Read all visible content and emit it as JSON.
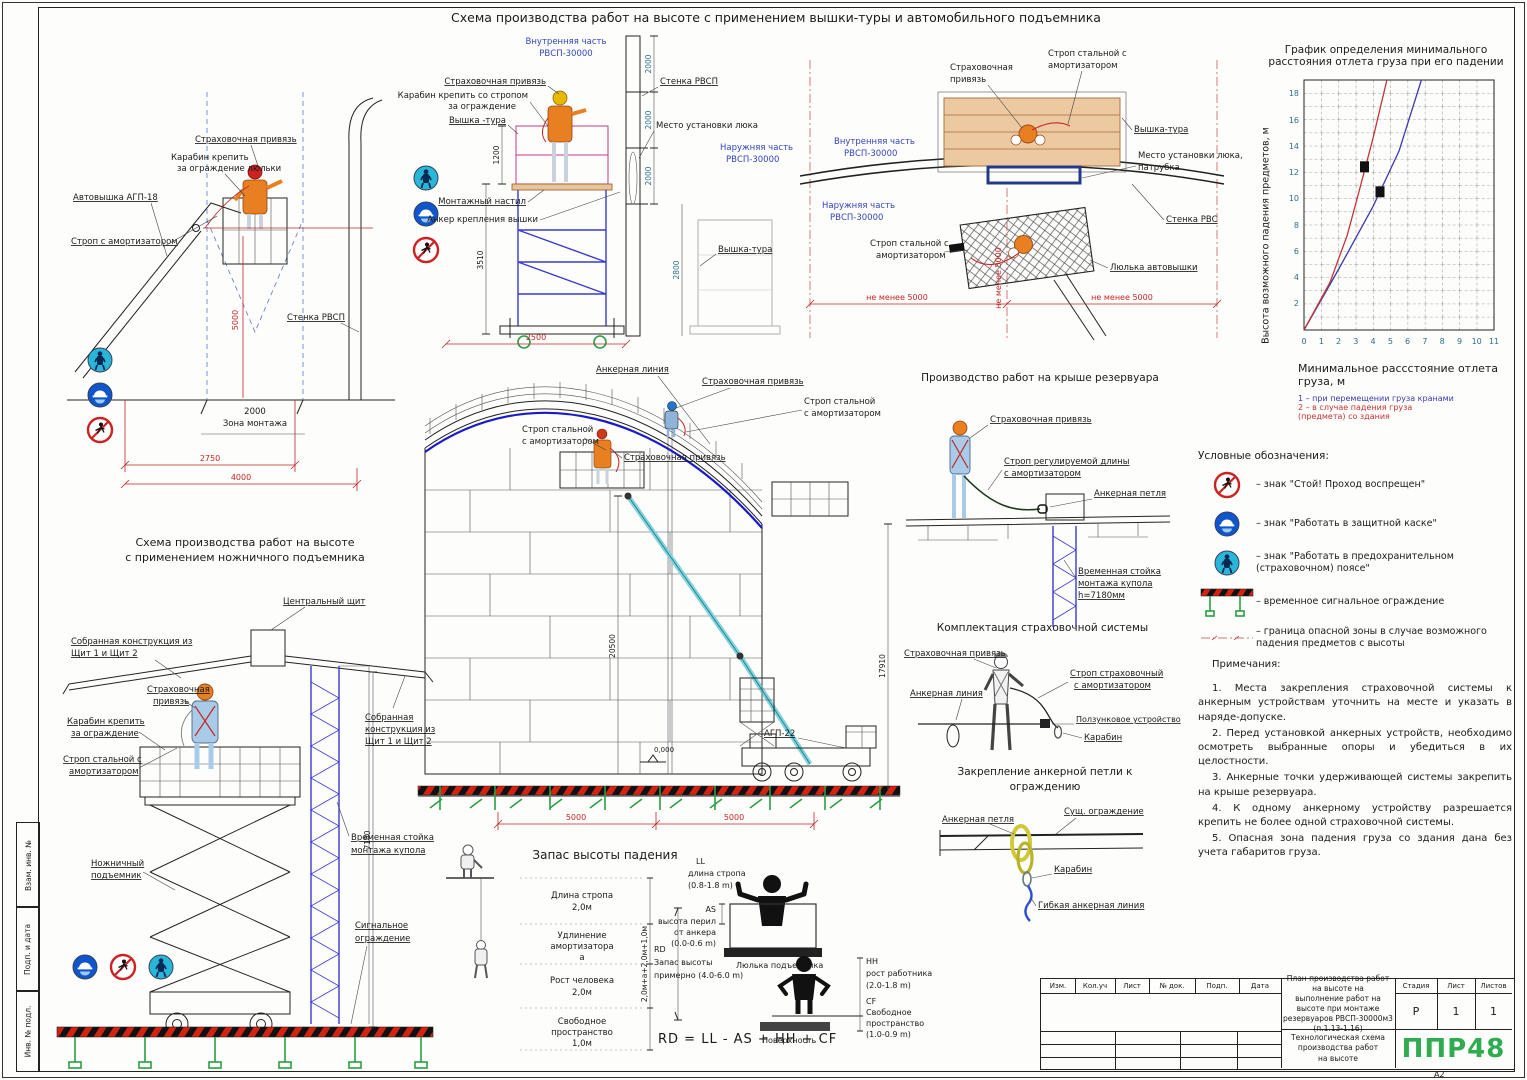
{
  "sheet": {
    "title": "Схема производства работ на высоте с применением вышки-туры и автомобильного подъемника",
    "format_label": "А2"
  },
  "margin_stamps": {
    "vzam": "Взам. инв. №",
    "podp": "Подп. и дата",
    "inv": "Инв. № подл."
  },
  "d_avto": {
    "privyaz": "Страховочная привязь",
    "karabin1": "Карабин крепить",
    "karabin2": "за ограждение люльки",
    "avtovyshka": "Автовышка АГП-18",
    "strop": "Строп с амортизатором",
    "stenka": "Стенка РВСП",
    "dim_5000": "5000",
    "dim_2000": "2000",
    "zona": "Зона монтажа",
    "dim_2750": "2750",
    "dim_4000": "4000"
  },
  "d_tura": {
    "inner1": "Внутренняя часть",
    "inner2": "РВСП-30000",
    "outer1": "Наружняя часть",
    "outer2": "РВСП-30000",
    "stenka": "Стенка РВСП",
    "privyaz": "Страховочная привязь",
    "karabin1": "Карабин крепить со стропом",
    "karabin2": "за ограждение",
    "tura_left": "Вышка -тура",
    "nastil": "Монтажный настил",
    "anker": "Анкер крепления вышки",
    "luk": "Место установки люка",
    "tura_right": "Вышка-тура",
    "dim_1200": "1200",
    "dim_3510": "3510",
    "dim_2500": "2500",
    "dim_2000a": "2000",
    "dim_2000b": "2000",
    "dim_2000c": "2000",
    "dim_2800": "2800"
  },
  "d_plan": {
    "strop1a": "Строп стальной с",
    "strop1b": "амортизатором",
    "privyaz1": "Страховочная",
    "privyaz2": "привязь",
    "inner1": "Внутренняя часть",
    "inner2": "РВСП-30000",
    "outer1": "Наружняя часть",
    "outer2": "РВСП-30000",
    "tura": "Вышка-тура",
    "luk1": "Место установки люка,",
    "luk2": "патрубка",
    "stenka": "Стенка РВС",
    "strop2a": "Строп стальной с",
    "strop2b": "амортизатором",
    "lulka": "Люлька автовышки",
    "dim_left": "не менее 5000",
    "dim_right": "не менее 5000",
    "dim_vert": "не менее 5000"
  },
  "chart": {
    "title1": "График определения минимального",
    "title2": "расстояния отлета груза при его падении",
    "ylabel": "Высота возможного падения предметов, м",
    "xlabel1": "Минимальное рассстояние отлета",
    "xlabel2": "груза, м",
    "note1": "1 – при перемещении груза кранами",
    "note2a": "2 – в случае падения груза",
    "note2b": "(предмета) со здания"
  },
  "chart_data": {
    "type": "line",
    "title": "График определения минимального расстояния отлета груза при его падении",
    "xlabel": "Минимальное рассстояние отлета груза, м",
    "ylabel": "Высота возможного падения предметов, м",
    "xlim": [
      0,
      11
    ],
    "ylim": [
      0,
      19
    ],
    "x_ticks": [
      "0",
      "1",
      "2",
      "3",
      "4",
      "5",
      "6",
      "7",
      "8",
      "9",
      "10",
      "11"
    ],
    "y_ticks": [
      "2",
      "4",
      "6",
      "8",
      "10",
      "12",
      "14",
      "16",
      "18"
    ],
    "grid": "dashed",
    "legend_position": "below",
    "series": [
      {
        "name": "1 – при перемещении груза кранами",
        "color": "#3a3aad",
        "points": [
          [
            0,
            0
          ],
          [
            2,
            4.6
          ],
          [
            4,
            9.4
          ],
          [
            5.5,
            13.6
          ],
          [
            6.8,
            19
          ]
        ]
      },
      {
        "name": "2 – в случае падения груза (предмета) со здания",
        "color": "#c23434",
        "points": [
          [
            0,
            0
          ],
          [
            1.5,
            3.6
          ],
          [
            2.5,
            7.2
          ],
          [
            3.2,
            10.6
          ],
          [
            4,
            14.6
          ],
          [
            4.8,
            19
          ]
        ]
      }
    ],
    "markers": [
      [
        3.5,
        12.4
      ],
      [
        4.4,
        10.5
      ]
    ]
  },
  "legend": {
    "title": "Условные обозначения:",
    "i1": "–  знак \"Стой! Проход воспрещен\"",
    "i2": "–  знак \"Работать в защитной каске\"",
    "i3": "–  знак \"Работать в предохранительном (страховочном) поясе\"",
    "i4": "–  временное сигнальное ограждение",
    "i5": "–  граница опасной зоны в случае возможного падения предметов с высоты"
  },
  "notes": {
    "title": "Примечания:",
    "n1": "1.  Места закрепления страховочной системы к анкерным устройствам уточнить на месте и указать в наряде-допуске.",
    "n2": "2.  Перед установкой анкерных устройств, необходимо осмотреть выбранные опоры и убедиться в их целостности.",
    "n3": "3.  Анкерные точки удерживающей системы закрепить на крыше резервуара.",
    "n4": "4.  К одному анкерному устройству разрешается крепить не более одной страховочной системы.",
    "n5": "5.  Опасная зона падения груза со здания дана без учета габаритов груза."
  },
  "d_scissor": {
    "title1": "Схема производства работ на высоте",
    "title2": "с применением ножничного подъемника",
    "schit": "Центральный щит",
    "sobr_l1": "Собранная конструкция из",
    "sobr_l2": "Щит 1 и Щит 2",
    "privyaz1": "Страховочная",
    "privyaz2": "привязь",
    "karabin1": "Карабин крепить",
    "karabin2": "за ограждение",
    "strop1": "Строп стальной с",
    "strop2": "амортизатором",
    "sobr_r1": "Собранная",
    "sobr_r2": "конструкция из",
    "sobr_r3": "Щит 1 и Щит 2",
    "lift1": "Ножничный",
    "lift2": "подъемник",
    "stoyka1": "Временная стойка",
    "stoyka2": "монтажа купола",
    "ogr1": "Сигнальное",
    "ogr2": "ограждение",
    "dim_7180": "7180"
  },
  "d_tank": {
    "anchor_line": "Анкерная линия",
    "privyaz_top": "Страховочная привязь",
    "strop_r1": "Строп стальной",
    "strop_r2": "с амортизатором",
    "strop_l1": "Строп стальной",
    "strop_l2": "с амортизатором",
    "privyaz_mid": "Страховочная привязь",
    "agp": "АГП-22",
    "level": "0,000",
    "dim_20500": "20500",
    "dim_17910": "17910",
    "dim_5000a": "5000",
    "dim_5000b": "5000"
  },
  "d_roof": {
    "title": "Производство работ на крыше резервуара",
    "privyaz": "Страховочная привязь",
    "strop1": "Строп регулируемой длины",
    "strop2": "с амортизатором",
    "petlya": "Анкерная петля",
    "stoyka1": "Временная стойка",
    "stoyka2": "монтажа купола",
    "stoyka3": "h=7180мм"
  },
  "d_kit": {
    "title": "Комплектация страховочной системы",
    "privyaz": "Страховочная привязь",
    "anchor_line": "Анкерная линия",
    "strop1": "Строп страховочный",
    "strop2": "с амортизатором",
    "polzunok": "Ползунковое устройство",
    "karabin": "Карабин"
  },
  "d_loop": {
    "title1": "Закрепление анкерной петли к",
    "title2": "ограждению",
    "petlya": "Анкерная петля",
    "ograzhdenie": "Сущ. ограждение",
    "karabin": "Карабин",
    "gibkaya": "Гибкая анкерная линия"
  },
  "d_fall": {
    "title": "Запас высоты падения",
    "l1a": "Длина стропа",
    "l1b": "2,0м",
    "l2a": "Удлинение",
    "l2b": "амортизатора",
    "l2c": "а",
    "l3a": "Рост человека",
    "l3b": "2,0м",
    "l4a": "Свободное",
    "l4b": "пространство",
    "l4c": "1,0м",
    "sum": "2,0м+а+2,0м+1,0м",
    "ll1": "LL",
    "ll2": "длина стропа",
    "ll3": "(0.8-1.8 m)",
    "as1": "AS",
    "as2": "высота перил",
    "as3": "от анкера",
    "as4": "(0.0-0.6 m)",
    "lulka": "Люлька подъемника",
    "rd1": "RD",
    "rd2": "Запас высоты",
    "rd3": "примерно (4.0-6.0 m)",
    "hh1": "HH",
    "hh2": "рост работника",
    "hh3": "(2.0-1.8 m)",
    "cf1": "CF",
    "cf2": "Свободное",
    "cf3": "пространство",
    "cf4": "(1.0-0.9 m)",
    "surface": "Поверхность",
    "formula": "RD = LL - AS + HH + CF"
  },
  "titleblock": {
    "h_izm": "Изм.",
    "h_kol": "Кол.уч",
    "h_list": "Лист",
    "h_dok": "№ док.",
    "h_podp": "Подп.",
    "h_data": "Дата",
    "doc1": "План производства работ на высоте на",
    "doc2": "выполнение работ на высоте при монтаже",
    "doc3": "резервуаров РВСП-30000м3 (п.1.13-1.16)",
    "h_stadiya": "Стадия",
    "h_list2": "Лист",
    "h_listov": "Листов",
    "v_stadiya": "Р",
    "v_list": "1",
    "v_listov": "1",
    "sub1": "Технологическая схема производства работ",
    "sub2": "на высоте",
    "logo": "ППР48",
    "logo_color": "#2fac4f"
  }
}
